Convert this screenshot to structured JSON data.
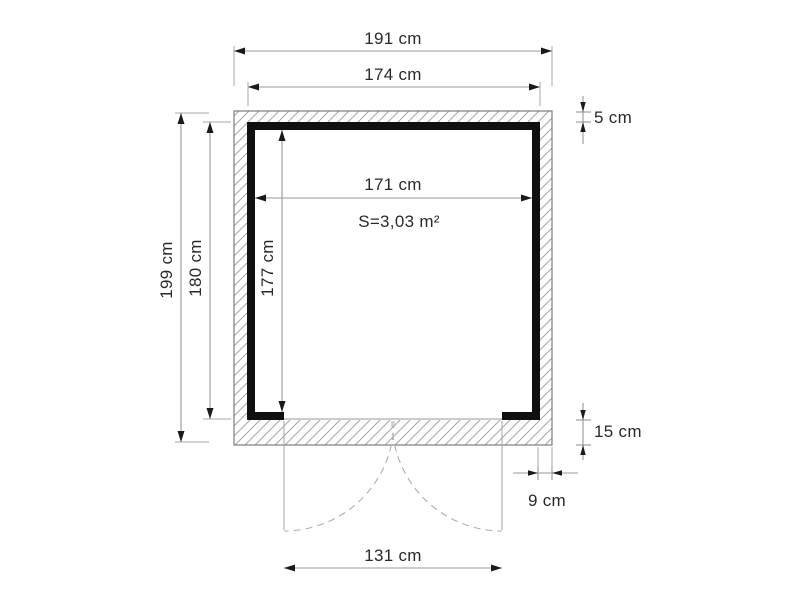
{
  "diagram": {
    "title": "shed floor plan",
    "dimensions": {
      "overall_width": {
        "label": "191 cm",
        "value": 191,
        "unit": "cm"
      },
      "body_width": {
        "label": "174 cm",
        "value": 174,
        "unit": "cm"
      },
      "overall_depth": {
        "label": "199 cm",
        "value": 199,
        "unit": "cm"
      },
      "body_depth": {
        "label": "180 cm",
        "value": 180,
        "unit": "cm"
      },
      "interior_width": {
        "label": "171 cm",
        "value": 171,
        "unit": "cm"
      },
      "interior_depth": {
        "label": "177 cm",
        "value": 177,
        "unit": "cm"
      },
      "wall_thickness": {
        "label": "5 cm",
        "value": 5,
        "unit": "cm"
      },
      "front_band": {
        "label": "15 cm",
        "value": 15,
        "unit": "cm"
      },
      "side_overhang": {
        "label": "9 cm",
        "value": 9,
        "unit": "cm"
      },
      "door_width": {
        "label": "131 cm",
        "value": 131,
        "unit": "cm"
      }
    },
    "area": {
      "label": "S=3,03 m²",
      "value": "3,03",
      "unit": "m²"
    },
    "colors": {
      "wall": "#101010",
      "hatch_line": "#a6a6a6",
      "outline": "#7d7d7d",
      "dimension_line": "#989898",
      "arrow": "#1a1a1a",
      "text": "#2a2a2a",
      "door_swing": "#b0b0b0",
      "background": "#ffffff"
    }
  }
}
